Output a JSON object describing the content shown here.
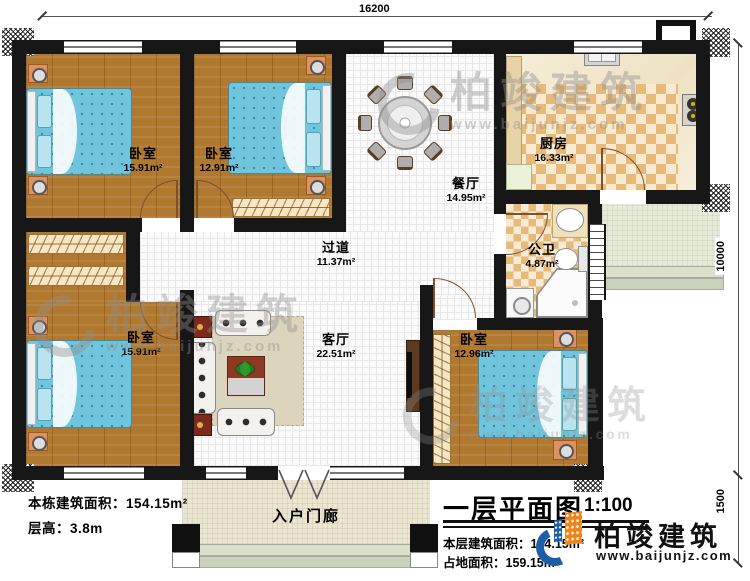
{
  "dims": {
    "top": "16200",
    "right": "10000",
    "right_lower": "1500"
  },
  "rooms": {
    "bedroom_tl": {
      "name": "卧室",
      "area": "15.91m²"
    },
    "bedroom_tm": {
      "name": "卧室",
      "area": "12.91m²"
    },
    "dining": {
      "name": "餐厅",
      "area": "14.95m²"
    },
    "kitchen": {
      "name": "厨房",
      "area": "16.33m²"
    },
    "bathroom": {
      "name": "公卫",
      "area": "4.87m²"
    },
    "corridor": {
      "name": "过道",
      "area": "11.37m²"
    },
    "living": {
      "name": "客厅",
      "area": "22.51m²"
    },
    "bedroom_bl": {
      "name": "卧室",
      "area": "15.91m²"
    },
    "bedroom_br": {
      "name": "卧室",
      "area": "12.96m²"
    },
    "porch": {
      "name": "入户门廊"
    }
  },
  "info": {
    "building_area_label": "本栋建筑面积：",
    "building_area_value": "154.15m²",
    "height_label": "层高：",
    "height_value": "3.8m"
  },
  "title_block": {
    "title": "一层平面图",
    "scale": "1:100",
    "floor_area_label": "本层建筑面积：",
    "floor_area_value": "154.15m²",
    "land_area_label": "占地面积：",
    "land_area_value": "159.15m²"
  },
  "brand": {
    "name": "柏竣建筑",
    "website": "www.baijunjz.com"
  },
  "watermark": {
    "name": "柏竣建筑",
    "website": "www.baijunjz.com"
  },
  "colors": {
    "wall": "#171717",
    "wood_floor": "#b1782f",
    "bed": "#70c4dc",
    "checker": "#e7ba79",
    "brand_blue": "#1c5fa8",
    "brand_orange": "#f08419"
  }
}
